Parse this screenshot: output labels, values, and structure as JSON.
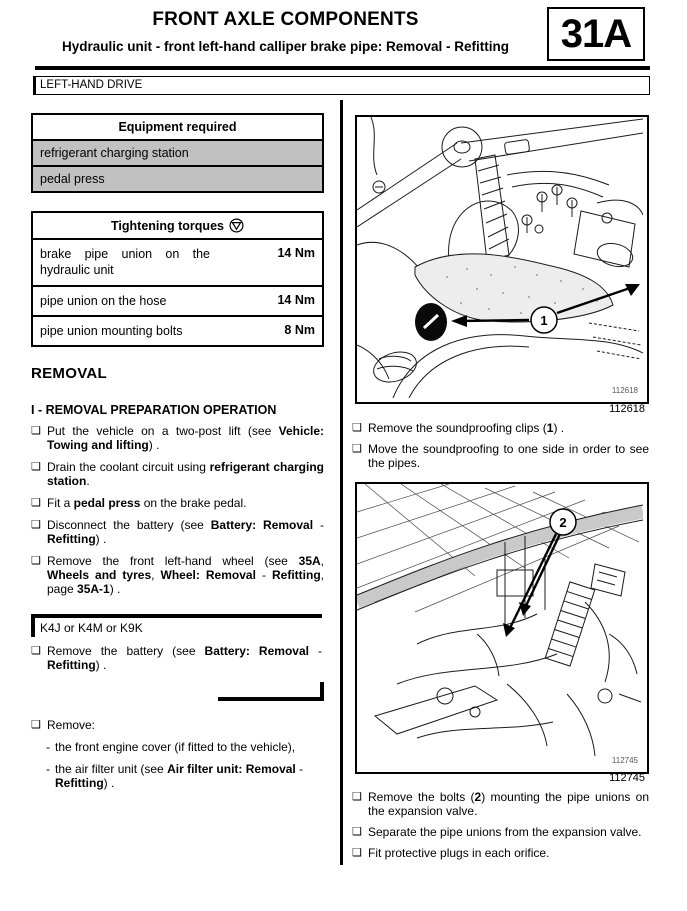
{
  "header": {
    "title": "FRONT AXLE COMPONENTS",
    "subtitle": "Hydraulic unit - front left-hand calliper brake pipe: Removal - Refitting",
    "section_code": "31A",
    "drive_banner": "LEFT-HAND DRIVE"
  },
  "glyphs": {
    "bullet": "❑",
    "dash": "-"
  },
  "equipment_table": {
    "title": "Equipment required",
    "rows": [
      {
        "label": "refrigerant charging station"
      },
      {
        "label": "pedal press"
      }
    ]
  },
  "torques_table": {
    "title": "Tightening torques",
    "icon": "torque-symbol-icon",
    "rows": [
      {
        "label": "brake pipe union on the hydraulic unit",
        "value": "14 Nm"
      },
      {
        "label": "pipe union on the hose",
        "value": "14 Nm"
      },
      {
        "label": "pipe union mounting bolts",
        "value": "8 Nm"
      }
    ]
  },
  "removal": {
    "heading": "REMOVAL",
    "subheading": "I - REMOVAL PREPARATION OPERATION",
    "steps": [
      {
        "segments": [
          {
            "t": "Put the vehicle on a two-post lift (see ",
            "b": false
          },
          {
            "t": "Vehicle: Towing and lifting",
            "b": true
          },
          {
            "t": ") .",
            "b": false
          }
        ]
      },
      {
        "segments": [
          {
            "t": "Drain the coolant circuit using ",
            "b": false
          },
          {
            "t": "refrigerant charging station",
            "b": true
          },
          {
            "t": ".",
            "b": false
          }
        ]
      },
      {
        "segments": [
          {
            "t": "Fit a ",
            "b": false
          },
          {
            "t": "pedal press",
            "b": true
          },
          {
            "t": " on the brake pedal.",
            "b": false
          }
        ]
      },
      {
        "segments": [
          {
            "t": "Disconnect the battery (see ",
            "b": false
          },
          {
            "t": "Battery: Removal",
            "b": true
          },
          {
            "t": " - ",
            "b": false
          },
          {
            "t": "Refitting",
            "b": true
          },
          {
            "t": ") .",
            "b": false
          }
        ]
      },
      {
        "segments": [
          {
            "t": "Remove the front left-hand wheel (see ",
            "b": false
          },
          {
            "t": "35A",
            "b": true
          },
          {
            "t": ", ",
            "b": false
          },
          {
            "t": "Wheels and tyres",
            "b": true
          },
          {
            "t": ", ",
            "b": false
          },
          {
            "t": "Wheel: Removal",
            "b": true
          },
          {
            "t": " - ",
            "b": false
          },
          {
            "t": "Refitting",
            "b": true
          },
          {
            "t": ", page ",
            "b": false
          },
          {
            "t": "35A-1",
            "b": true
          },
          {
            "t": ") .",
            "b": false
          }
        ]
      }
    ],
    "variant": {
      "label": "K4J or K4M or K9K",
      "steps": [
        {
          "segments": [
            {
              "t": "Remove the battery (see ",
              "b": false
            },
            {
              "t": "Battery: Removal",
              "b": true
            },
            {
              "t": " - ",
              "b": false
            },
            {
              "t": "Refitting",
              "b": true
            },
            {
              "t": ") .",
              "b": false
            }
          ]
        }
      ]
    },
    "remove_group": {
      "head": {
        "segments": [
          {
            "t": "Remove:",
            "b": false
          }
        ]
      },
      "subs": [
        {
          "segments": [
            {
              "t": "the front engine cover (if fitted to the vehicle),",
              "b": false
            }
          ]
        },
        {
          "segments": [
            {
              "t": "the air filter unit (see ",
              "b": false
            },
            {
              "t": "Air filter unit: Removal",
              "b": true
            },
            {
              "t": " - ",
              "b": false
            },
            {
              "t": "Refitting",
              "b": true
            },
            {
              "t": ") .",
              "b": false
            }
          ]
        }
      ]
    }
  },
  "figures": [
    {
      "id": "112618",
      "callout": "1",
      "captions": [
        {
          "segments": [
            {
              "t": "Remove the soundproofing clips (",
              "b": false
            },
            {
              "t": "1",
              "b": true
            },
            {
              "t": ") .",
              "b": false
            }
          ]
        },
        {
          "segments": [
            {
              "t": "Move the soundproofing to one side in order to see the pipes.",
              "b": false
            }
          ]
        }
      ]
    },
    {
      "id": "112745",
      "callout": "2",
      "captions": [
        {
          "segments": [
            {
              "t": "Remove the bolts (",
              "b": false
            },
            {
              "t": "2",
              "b": true
            },
            {
              "t": ") mounting the pipe unions on the expansion valve.",
              "b": false
            }
          ]
        },
        {
          "segments": [
            {
              "t": "Separate the pipe unions from the expansion valve.",
              "b": false
            }
          ]
        },
        {
          "segments": [
            {
              "t": "Fit protective plugs in each orifice.",
              "b": false
            }
          ]
        }
      ]
    }
  ],
  "colors": {
    "ink": "#000000",
    "table_row_gray": "#c1c1c1",
    "paper": "#ffffff"
  }
}
